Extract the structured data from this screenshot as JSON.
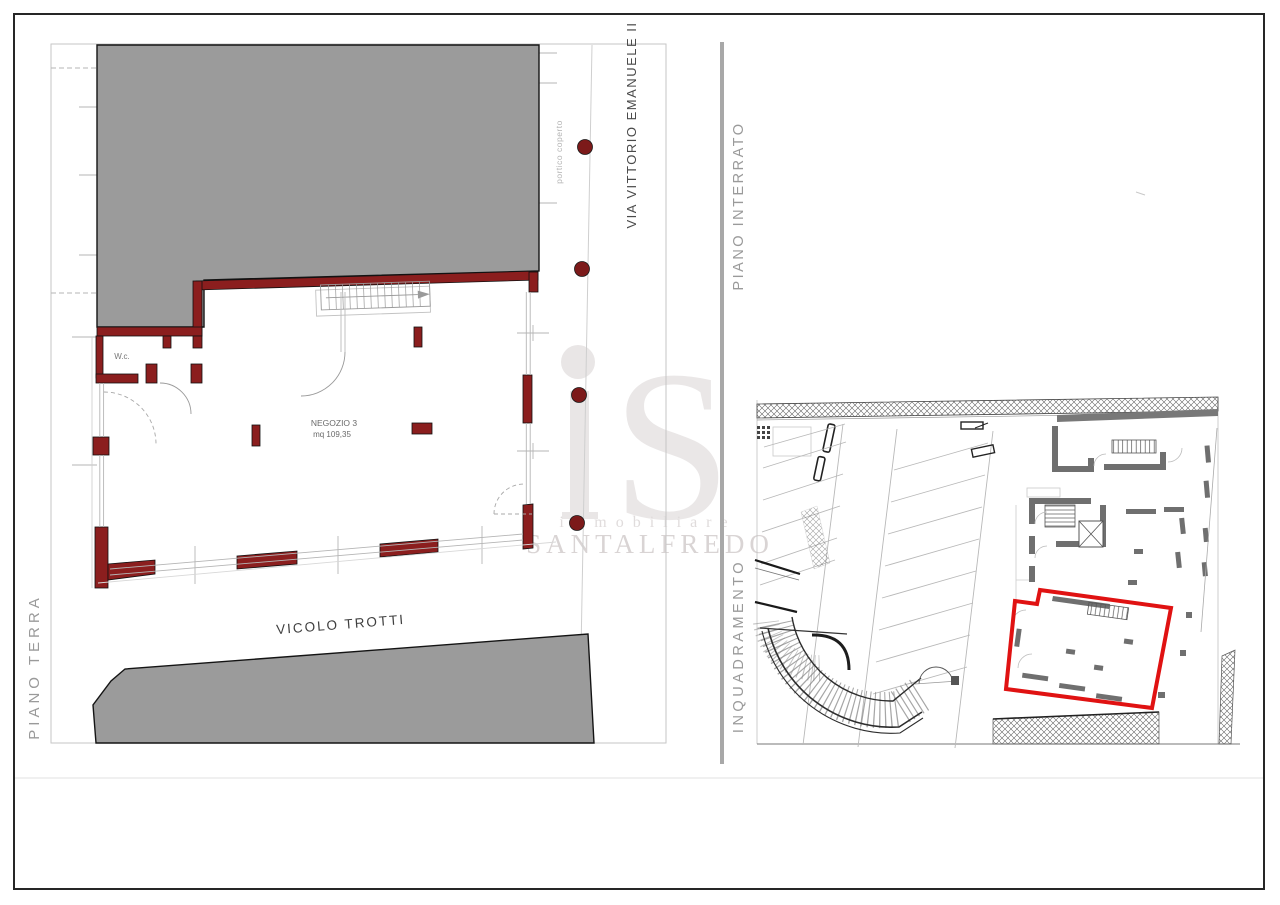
{
  "left_plan": {
    "title": "PIANO TERRA",
    "street_top": "VIA VITTORIO EMANUELE II",
    "portico_label": "portico coperto",
    "street_bottom": "VICOLO TROTTI",
    "room_label": "NEGOZIO 3",
    "room_area": "mq 109,35",
    "wc_label": "W.c."
  },
  "right_plan": {
    "title": "PIANO INTERRATO",
    "subtitle": "INQUADRAMENTO"
  },
  "watermark": {
    "logo": "iS",
    "logo_s": "S",
    "line1": "immobiliare",
    "line2": "SANTALFREDO"
  },
  "colors": {
    "wall_red": "#8b1e1e",
    "column_red": "#7c1a1a",
    "highlight_red": "#e01212",
    "building_gray": "#9b9b9b",
    "site_wall_gray": "#6f6f6f",
    "divider_gray": "#a8a8a8",
    "label_gray": "#9a9a9a",
    "watermark_gray": "#e7e4e4"
  }
}
